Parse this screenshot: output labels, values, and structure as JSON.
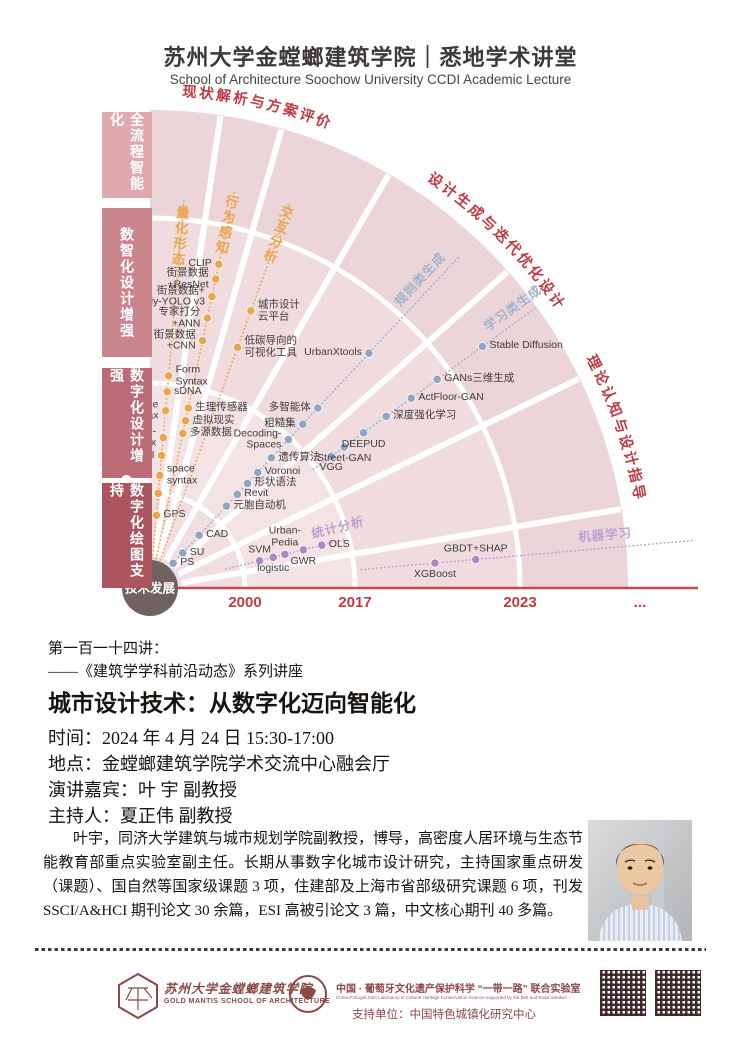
{
  "header": {
    "title": "苏州大学金螳螂建筑学院｜悉地学术讲堂",
    "subtitle": "School of Architecture Soochow University CCDI Academic Lecture"
  },
  "diagram": {
    "origin_label": "技术发展",
    "era_bars": [
      {
        "label": "全流程智能化",
        "color": "#dfa9ae",
        "y": 112,
        "h": 86
      },
      {
        "label": "数智化设计增强",
        "color": "#cb858c",
        "y": 208,
        "h": 149
      },
      {
        "label": "数字化设计增强",
        "color": "#bb6b75",
        "y": 368,
        "h": 110
      },
      {
        "label": "数字化绘图支持",
        "color": "#aa5560",
        "y": 483,
        "h": 105
      }
    ],
    "rings": {
      "radii": [
        95,
        205,
        370,
        478
      ],
      "fills": [
        "#f1dee0",
        "#f3e3e4",
        "#f0dcde",
        "#ecd5d8"
      ]
    },
    "gaps": [
      8.5,
      16,
      30,
      48.5,
      64,
      80.5
    ],
    "arc_labels": [
      {
        "text": "现状解析与方案评价",
        "offset": "14%"
      },
      {
        "text": "设计生成与迭代优化设计",
        "offset": "50%"
      },
      {
        "text": "理论认知与设计指导",
        "offset": "79%"
      }
    ],
    "arc_label_color": "#bf3b43",
    "axis_color": "#c3494e",
    "timeline": {
      "ticks": [
        {
          "label": "2000",
          "x": 245
        },
        {
          "label": "2017",
          "x": 355
        },
        {
          "label": "2023",
          "x": 520
        },
        {
          "label": "...",
          "x": 640
        }
      ]
    },
    "lines": [
      {
        "name": "量化形态",
        "color": "#eaa64d",
        "dot": "#eaa64d",
        "angle": 5,
        "ray": [
          10,
          392
        ],
        "name_label": {
          "r": 372,
          "style": "stack"
        },
        "points": [
          {
            "label": "GPS",
            "r": 73,
            "pos": "right"
          },
          {
            "label": "ArcGIS",
            "r": 95,
            "pos": "left"
          },
          {
            "label": "space\nsyntax",
            "r": 113,
            "pos": "right"
          },
          {
            "label": "MXI",
            "r": 133,
            "pos": "left"
          },
          {
            "label": "Space-\nmatrix",
            "r": 151,
            "pos": "left"
          },
          {
            "label": "Place\nSyntax",
            "r": 178,
            "pos": "left"
          },
          {
            "label": "sDNA",
            "r": 197,
            "pos": "right"
          },
          {
            "label": "Form\nSyntax",
            "r": 213,
            "pos": "right"
          }
        ]
      },
      {
        "name": "行为感知",
        "color": "#eaa64d",
        "dot": "#eaa64d",
        "angle": 12,
        "ray": [
          10,
          405
        ],
        "name_label": {
          "r": 390,
          "style": "stack"
        },
        "points": [
          {
            "label": "多源数据",
            "r": 158,
            "pos": "right"
          },
          {
            "label": "虚拟现实",
            "r": 171,
            "pos": "right"
          },
          {
            "label": "生理传感器",
            "r": 184,
            "pos": "right"
          },
          {
            "label": "街景数据\n+CNN",
            "r": 253,
            "pos": "left"
          },
          {
            "label": "专家打分\n+ANN",
            "r": 276,
            "pos": "left"
          },
          {
            "label": "街景数据+\nPoly-YOLO v3",
            "r": 298,
            "pos": "left"
          },
          {
            "label": "街景数据\n+ResNet",
            "r": 316,
            "pos": "left"
          },
          {
            "label": "CLIP",
            "r": 331,
            "pos": "left"
          }
        ]
      },
      {
        "name": "交互分析",
        "color": "#eaa64d",
        "dot": "#eaa64d",
        "angle": 20,
        "ray": [
          10,
          408
        ],
        "name_label": {
          "r": 395,
          "style": "stack"
        },
        "points": [
          {
            "label": "低碳导向的\n可视化工具",
            "r": 256,
            "pos": "right"
          },
          {
            "label": "城市设计\n云平台",
            "r": 295,
            "pos": "right"
          }
        ]
      },
      {
        "name": "规则类生成",
        "color": "#9fb3cc",
        "dot": "#8ea6c4",
        "angle": 43,
        "ray": [
          30,
          455
        ],
        "name_label": {
          "r": 410,
          "style": "along"
        },
        "points": [
          {
            "label": "PS",
            "r": 34,
            "pos": "right"
          },
          {
            "label": "SU",
            "r": 48,
            "pos": "right"
          },
          {
            "label": "CAD",
            "r": 72,
            "pos": "right"
          },
          {
            "label": "元胞自动机",
            "r": 112,
            "pos": "right"
          },
          {
            "label": "Revit",
            "r": 128,
            "pos": "right"
          },
          {
            "label": "形状语法",
            "r": 143,
            "pos": "right"
          },
          {
            "label": "Voronoi",
            "r": 158,
            "pos": "right"
          },
          {
            "label": "遗传算法",
            "r": 178,
            "pos": "right"
          },
          {
            "label": "Decoding-\nSpaces",
            "r": 203,
            "pos": "left"
          },
          {
            "label": "粗糙集",
            "r": 224,
            "pos": "left"
          },
          {
            "label": "多智能体",
            "r": 246,
            "pos": "left"
          },
          {
            "label": "UrbanXtools",
            "r": 321,
            "pos": "left"
          }
        ]
      },
      {
        "name": "学习类生成",
        "color": "#9fb3cc",
        "dot": "#8ea6c4",
        "angle": 54,
        "ray": [
          202,
          476
        ],
        "name_label": {
          "r": 458,
          "style": "along"
        },
        "points": [
          {
            "label": "VGG",
            "r": 224,
            "pos": "below"
          },
          {
            "label": "Street-GAN",
            "r": 240,
            "pos": "below"
          },
          {
            "label": "DEEPUD",
            "r": 264,
            "pos": "below"
          },
          {
            "label": "深度强化学习",
            "r": 292,
            "pos": "right"
          },
          {
            "label": "ActFloor-GAN",
            "r": 323,
            "pos": "right"
          },
          {
            "label": "GANs三维生成",
            "r": 355,
            "pos": "right"
          },
          {
            "label": "Stable Diffusion",
            "r": 411,
            "pos": "right"
          }
        ]
      },
      {
        "name": "统计分析",
        "color": "#bf9fd2",
        "dot": "#ad89c4",
        "angle": 76,
        "ray": [
          78,
          200
        ],
        "name_label": {
          "r": 197,
          "style": "along"
        },
        "points": [
          {
            "label": "SVM",
            "r": 113,
            "pos": "above"
          },
          {
            "label": "logistic",
            "r": 127,
            "pos": "below"
          },
          {
            "label": "Urban-\nPedia",
            "r": 139,
            "pos": "above"
          },
          {
            "label": "GWR",
            "r": 158,
            "pos": "below"
          },
          {
            "label": "OLS",
            "r": 177,
            "pos": "right"
          }
        ]
      },
      {
        "name": "机器学习",
        "color": "#bf9fd2",
        "dot": "#ad89c4",
        "angle": 85,
        "ray": [
          212,
          545
        ],
        "name_label": {
          "r": 458,
          "style": "along"
        },
        "points": [
          {
            "label": "XGBoost",
            "r": 286,
            "pos": "below"
          },
          {
            "label": "GBDT+SHAP",
            "r": 327,
            "pos": "above"
          }
        ]
      }
    ]
  },
  "lecture": {
    "series_no": "第一百一十四讲：",
    "series_name": "——《建筑学学科前沿动态》系列讲座",
    "title": "城市设计技术：从数字化迈向智能化",
    "time": "时间：2024 年 4 月 24 日 15:30-17:00",
    "location": "地点：金螳螂建筑学院学术交流中心融会厅",
    "speaker": "演讲嘉宾：叶 宇 副教授",
    "host": "主持人：夏正伟 副教授",
    "bio": "叶宇，同济大学建筑与城市规划学院副教授，博导，高密度人居环境与生态节能教育部重点实验室副主任。长期从事数字化城市设计研究，主持国家重点研发（课题）、国自然等国家级课题 3 项，住建部及上海市省部级研究课题 6 项，刊发 SSCI/A&HCI 期刊论文 30 余篇，ESI 高被引论文 3 篇，中文核心期刊 40 多篇。"
  },
  "footer": {
    "school_cn": "苏州大学金螳螂建筑学院",
    "school_en": "GOLD MANTIS SCHOOL OF ARCHITECTURE",
    "lab_cn": "中国 · 葡萄牙文化遗产保护科学 “一带一路” 联合实验室",
    "lab_en": "China-Portugal Joint Laboratory of Cultural Heritage Conservation Science supported by the Belt and Road Initiative",
    "support": "支持单位：中国特色城镇化研究中心"
  }
}
